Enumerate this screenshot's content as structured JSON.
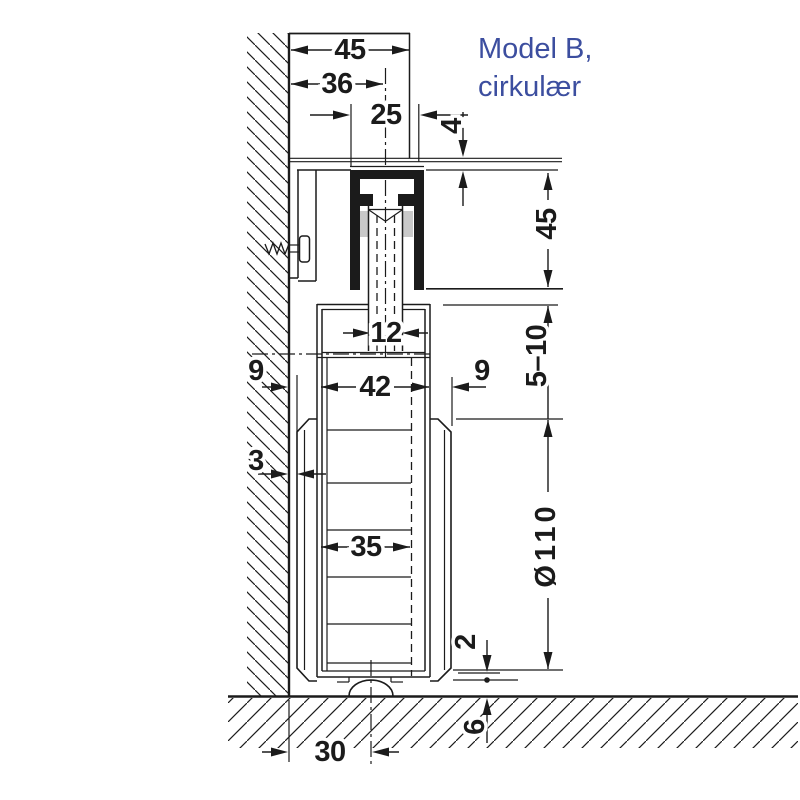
{
  "title": {
    "line1": "Model B,",
    "line2": "cirkulær"
  },
  "colors": {
    "line": "#1b1b1b",
    "annotation_blue": "#3c4e9f",
    "roller_pad_gray": "#c9c9c9",
    "background": "#ffffff"
  },
  "dims": {
    "top_total": "45",
    "top_to_center": "36",
    "track_width": "25",
    "ceiling_gap": "4",
    "track_height": "45",
    "top_clearance": "5–10",
    "bolt_width": "12",
    "left_gap": "9",
    "door_width": "42",
    "right_gap": "9",
    "wall_clearance": "3",
    "panel_width": "35",
    "wheel_diameter": "Ø110",
    "bottom_gap": "2",
    "floor_depth": "6",
    "guide_offset": "30"
  }
}
